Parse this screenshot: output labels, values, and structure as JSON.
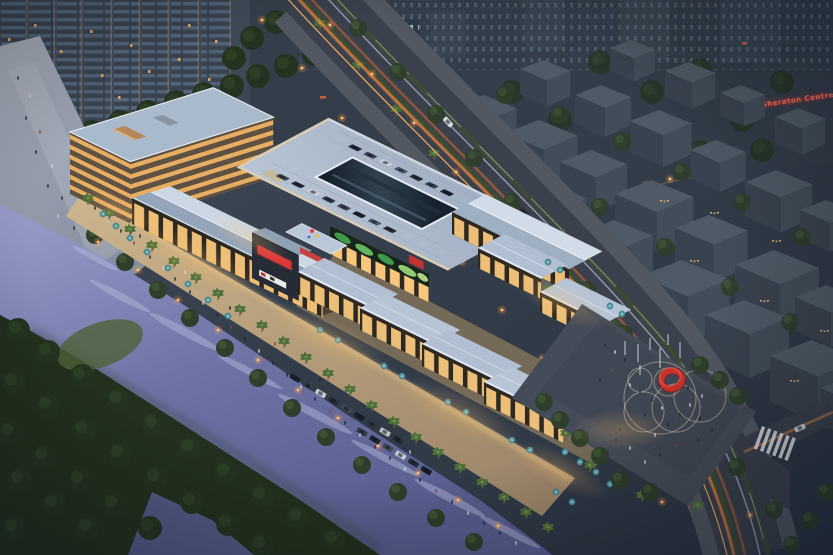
{
  "scene": {
    "description": "Aerial dusk architectural rendering of a riverside open-air shopping mall complex with rooftop parking, waterfront promenade, entrance plaza with red ring sculpture, boulevard with light trails, residential towers and dense city blocks",
    "type": "architectural-rendering",
    "time_of_day": "dusk",
    "signs": {
      "sheraton": "Sheraton Centre"
    },
    "palette": {
      "sky_city": "#36414e",
      "city_block_top": "#4e5a66",
      "city_block_face": "#39434f",
      "tower_facade": "#3a4654",
      "window_warm": "#f2b566",
      "roof_light": "#c6d2e0",
      "roof_shade": "#94a5b9",
      "deck": "#aebaca",
      "skylight_glass": "#101a26",
      "water": "#6a71a3",
      "forest": "#243320",
      "palm_green": "#4f7038",
      "promenade": "#c2a87f",
      "umbrella_teal": "#4f97a3",
      "plaza_paving": "#454c59",
      "sculpture_red": "#c8312b",
      "sign_red": "#cf2f2f",
      "light_trail_orange": "#ff8f3a",
      "street_lamp": "#ffc580"
    }
  }
}
